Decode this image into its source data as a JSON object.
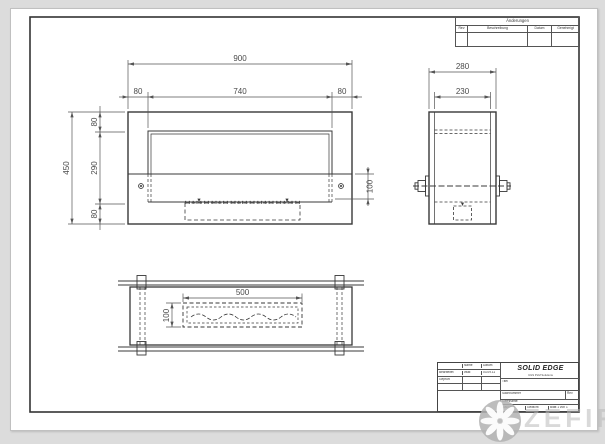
{
  "dims": {
    "front": {
      "total_w": "900",
      "left": "80",
      "opening": "740",
      "right": "80",
      "total_h": "450",
      "top": "80",
      "mid": "290",
      "bottom": "80",
      "strip": "100"
    },
    "side": {
      "total": "280",
      "inner": "230"
    },
    "plan": {
      "slot_len": "500",
      "slot_w": "100"
    }
  },
  "revision_table": {
    "title": "Änderungen",
    "col_rev": "Rev",
    "col_beschr": "Beschreibung",
    "col_datum": "Datum",
    "col_genehmigt": "Genehmigt"
  },
  "title_block": {
    "name_col": "Name",
    "datum_col": "Datum",
    "row1_label": "Bearbeitet",
    "row1_name": "vitali",
    "row1_date": "03.09.11",
    "row2_label": "Geprüft",
    "brand": "SOLID EDGE",
    "brand_sub": "UGS PLM Solutions",
    "titel": "Titel",
    "sachnummer": "Sachnummer",
    "rev": "Rev",
    "dateiname": "Dateiname:",
    "massstab": "Maßstab",
    "gewicht": "Gewicht",
    "blatt": "Blatt 1 von 1"
  },
  "watermark": {
    "text": "ZEFIRE"
  }
}
